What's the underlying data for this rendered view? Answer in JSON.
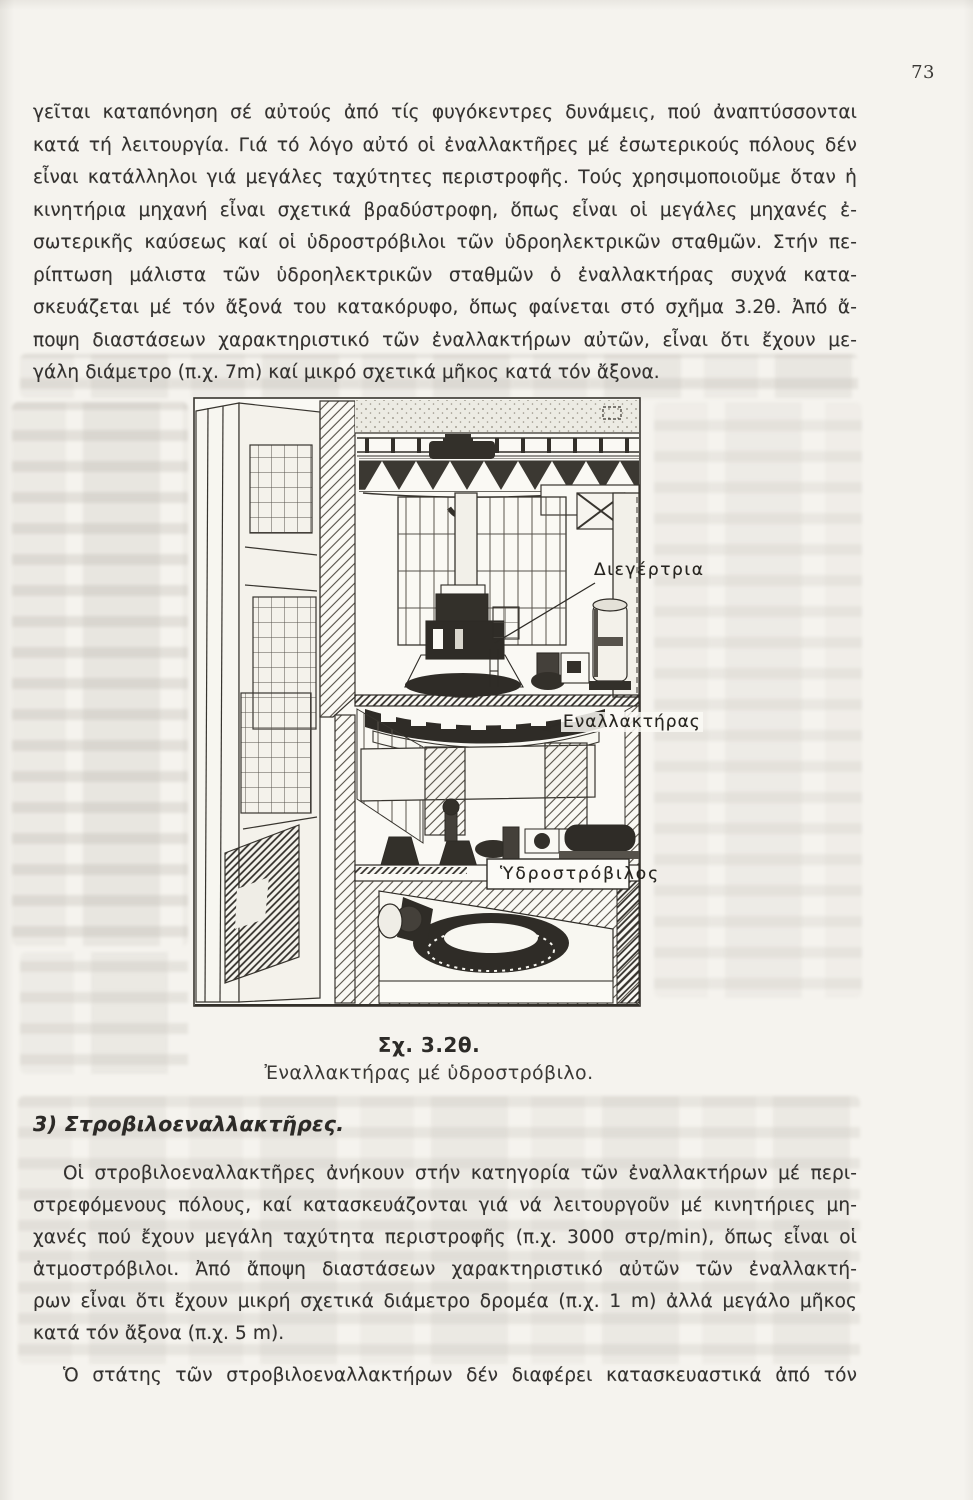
{
  "page": {
    "number": "73"
  },
  "intro_paragraph": {
    "lines": [
      "γεῖται καταπόνηση σέ αὐτούς ἀπό τίς φυγόκεντρες δυνάμεις, πού ἀναπτύσσονται",
      "κατά τή λειτουργία. Γιά τό λόγο αὐτό οἱ ἐναλλακτῆρες μέ ἐσωτερικούς πόλους δέν",
      "εἶναι κατάλληλοι γιά μεγάλες ταχύτητες περιστροφῆς. Τούς χρησιμοποιοῦμε ὅταν ἡ",
      "κινητήρια μηχανή εἶναι σχετικά βραδύστροφη, ὅπως εἶναι οἱ μεγάλες μηχανές ἐ-",
      "σωτερικῆς καύσεως καί οἱ ὑδροστρόβιλοι τῶν ὑδροηλεκτρικῶν σταθμῶν. Στήν πε-",
      "ρίπτωση μάλιστα τῶν ὑδροηλεκτρικῶν σταθμῶν ὁ ἐναλλακτήρας συχνά κατα-",
      "σκευάζεται μέ τόν ἄξονά του κατακόρυφο, ὅπως φαίνεται στό σχῆμα 3.2θ. Ἀπό ἄ-",
      "ποψη διαστάσεων χαρακτηριστικό τῶν ἐναλλακτήρων αὐτῶν, εἶναι ὅτι ἔχουν με-",
      "γάλη διάμετρο (π.χ. 7m) καί μικρό σχετικά μῆκος κατά τόν ἄξονα."
    ]
  },
  "figure": {
    "labels": {
      "exciter": "Διεγέρτρια",
      "alternator": "Εναλλακτήρας",
      "turbine": "Ὑδροστρόβιλος"
    },
    "caption_title": "Σχ. 3.2θ.",
    "caption_text": "Ἐναλλακτήρας μέ ὑδροστρόβιλο."
  },
  "section3": {
    "heading": "3) Στροβιλοεναλλακτῆρες.",
    "paragraph": {
      "lines": [
        "Οἱ στροβιλοεναλλακτῆρες ἀνήκουν στήν κατηγορία τῶν ἐναλλακτήρων μέ περι-",
        "στρεφόμενους πόλους, καί κατασκευάζονται γιά νά λειτουργοῦν μέ κινητήριες μη-",
        "χανές πού ἔχουν μεγάλη ταχύτητα περιστροφῆς (π.χ. 3000 στρ/min), ὅπως εἶναι οἱ",
        "ἀτμοστρόβιλοι. Ἀπό ἄποψη διαστάσεων χαρακτηριστικό αὐτῶν τῶν ἐναλλακτή-",
        "ρων εἶναι ὅτι ἔχουν μικρή σχετικά διάμετρο δρομέα (π.χ. 1 m) ἀλλά μεγάλο μῆκος",
        "κατά τόν ἄξονα (π.χ. 5 m)."
      ]
    },
    "paragraph2": {
      "lines": [
        "Ὁ στάτης τῶν στροβιλοεναλλακτήρων δέν διαφέρει κατασκευαστικά ἀπό τόν"
      ]
    }
  }
}
